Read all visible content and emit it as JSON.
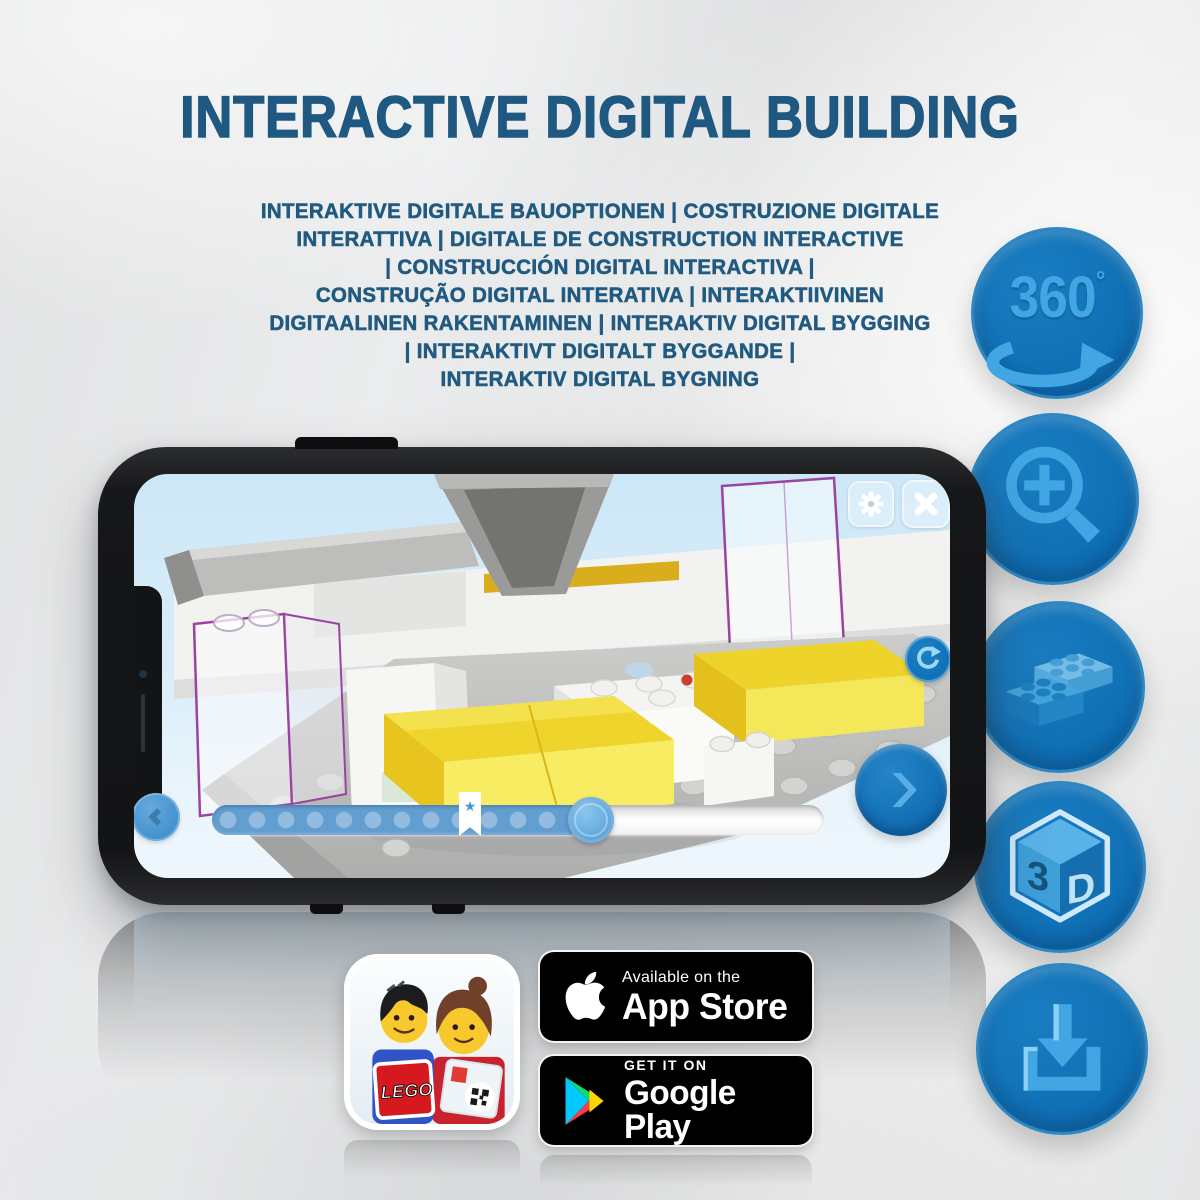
{
  "title": "INTERACTIVE DIGITAL BUILDING",
  "subtitle_lines": [
    "INTERAKTIVE DIGITALE BAUOPTIONEN | COSTRUZIONE DIGITALE",
    "INTERATTIVA | DIGITALE DE CONSTRUCTION INTERACTIVE",
    "| CONSTRUCCIÓN DIGITAL INTERACTIVA |",
    "CONSTRUÇÃO DIGITAL INTERATIVA | INTERAKTIIVINEN",
    "DIGITAALINEN RAKENTAMINEN | INTERAKTIV DIGITAL BYGGING",
    "| INTERAKTIVT DIGITALT BYGGANDE |",
    "INTERAKTIV DIGITAL BYGNING"
  ],
  "features": {
    "rotate360": {
      "icon": "360-rotation-arrow-icon",
      "value": "360",
      "unit": "°"
    },
    "zoom": {
      "icon": "zoom-in-magnifier-icon"
    },
    "bricks": {
      "icon": "lego-bricks-icon"
    },
    "cube3d": {
      "icon": "3d-cube-icon",
      "left": "3",
      "right": "D"
    },
    "download": {
      "icon": "download-tray-icon"
    }
  },
  "phone": {
    "app": {
      "toolbar": {
        "settings_icon": "gear-icon",
        "close_icon": "x-icon"
      },
      "rotate_icon": "circular-arrow-icon",
      "nav": {
        "back_icon": "chevron-left-icon",
        "next_icon": "chevron-right-icon"
      },
      "slider": {
        "progress_percent": 65,
        "dot_count": 13,
        "bookmark_star": "★"
      }
    }
  },
  "store_badges": {
    "app_store": {
      "tagline": "Available on the",
      "store_name": "App Store",
      "logo": "apple-logo"
    },
    "google_play": {
      "tagline": "GET IT ON",
      "store_name": "Google Play",
      "logo": "play-triangle-logo"
    }
  },
  "app_icon": {
    "brand": "LEGO"
  },
  "colors": {
    "title_blue": "#1F5880",
    "circle_fill": "#0F70B5",
    "icon_light_blue": "#41A6E3",
    "screen_sky": "#D5EAF7",
    "yellow_brick": "#F2D933",
    "ghost_outline_purple": "#9B43A0",
    "slider_fill": "#639ED1"
  }
}
